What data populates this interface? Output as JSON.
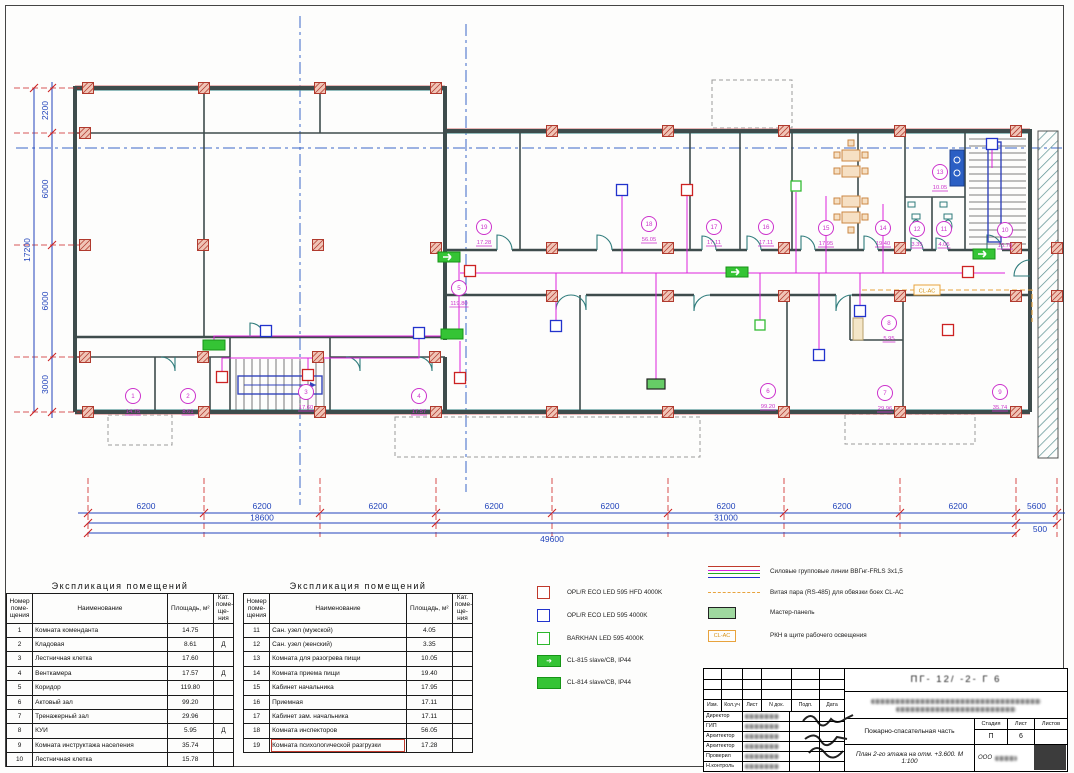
{
  "sheet": {
    "plan_caption": "План 2-го этажа на отм. +3.600. М 1:100"
  },
  "explication": {
    "title": "Экспликация помещений",
    "headers": [
      "Номер поме-щения",
      "Наименование",
      "Площадь, м²",
      "Кат. поме-ще-ния"
    ],
    "left_rows": [
      [
        "1",
        "Комната коменданта",
        "14.75",
        ""
      ],
      [
        "2",
        "Кладовая",
        "8.61",
        "Д"
      ],
      [
        "3",
        "Лестничная клетка",
        "17.60",
        ""
      ],
      [
        "4",
        "Венткамера",
        "17.57",
        "Д"
      ],
      [
        "5",
        "Коридор",
        "119.80",
        ""
      ],
      [
        "6",
        "Актовый зал",
        "99.20",
        ""
      ],
      [
        "7",
        "Тренажерный зал",
        "29.96",
        ""
      ],
      [
        "8",
        "КУИ",
        "5.95",
        "Д"
      ],
      [
        "9",
        "Комната инструктажа населения",
        "35.74",
        ""
      ],
      [
        "10",
        "Лестничная клетка",
        "15.78",
        ""
      ]
    ],
    "right_rows": [
      [
        "11",
        "Сан. узел (мужской)",
        "4.05",
        ""
      ],
      [
        "12",
        "Сан. узел (женский)",
        "3.35",
        ""
      ],
      [
        "13",
        "Комната для разогрева пищи",
        "10.05",
        ""
      ],
      [
        "14",
        "Комната приема пищи",
        "19.40",
        ""
      ],
      [
        "15",
        "Кабинет начальника",
        "17.95",
        ""
      ],
      [
        "16",
        "Приемная",
        "17.11",
        ""
      ],
      [
        "17",
        "Кабинет зам. начальника",
        "17.11",
        ""
      ],
      [
        "18",
        "Комната инспекторов",
        "56.05",
        ""
      ],
      [
        "19",
        "Комната психологической разгрузки",
        "17.28",
        ""
      ]
    ],
    "highlighted_room": "19"
  },
  "legend": {
    "fixtures": [
      {
        "sym": "sq red",
        "label": "OPL/R ECO LED 595 HFD 4000K"
      },
      {
        "sym": "sq blue",
        "label": "OPL/R ECO LED 595 4000K"
      },
      {
        "sym": "sq green",
        "label": "BARKHAN LED 595 4000K"
      },
      {
        "sym": "exit arrow",
        "label": "CL-815 slave/СВ, IP44"
      },
      {
        "sym": "exit solid",
        "label": "CL-814 slave/СВ, IP44"
      }
    ],
    "lines": [
      {
        "sym": "linestack",
        "label": "Силовые групповые линии ВВГнг-FRLS 3х1,5"
      },
      {
        "sym": "odash",
        "label": "Витая пара (RS-485) для обвязки боех CL-АС"
      },
      {
        "sym": "mpanel",
        "label": "Мастер-панель"
      },
      {
        "sym": "clacbox",
        "label": "РКН в щите рабочего освещения",
        "boxtext": "CL-АС"
      }
    ],
    "line_colors": [
      "#c0392b",
      "#dd22dd",
      "#22aa22",
      "#2233cc"
    ]
  },
  "titleblock": {
    "doc_number": "ПГ- 12/ -2- Г 6",
    "header_cols": [
      "Изм.",
      "Кол.уч",
      "Лист",
      "N док.",
      "Подп.",
      "Дата"
    ],
    "roles": [
      "Директор",
      "ГИП",
      "Архитектор",
      "Архитектор",
      "Проверил",
      "Н.контроль"
    ],
    "section_label": "Пожарно-спасательная часть",
    "sheet_label": "План 2-го этажа на отм. +3.600. М 1:100",
    "stage_headers": [
      "Стадия",
      "Лист",
      "Листов"
    ],
    "stage_value": "П",
    "sheet_value": "6",
    "company_prefix": "ООО"
  },
  "plan": {
    "cl_ac_label": "CL-АС",
    "dims": {
      "bottom_segments": [
        "6200",
        "6200",
        "6200",
        "6200",
        "6200",
        "6200",
        "6200",
        "6200",
        "5600"
      ],
      "bottom_totals": [
        {
          "label": "18600",
          "x1": 88,
          "x2": 436
        },
        {
          "label": "31000",
          "x1": 436,
          "x2": 1016
        }
      ],
      "bottom_overall": {
        "label": "49600",
        "x1": 88,
        "x2": 1016
      },
      "bottom_extra": "500",
      "left_segments": [
        "2200",
        "6000",
        "6000",
        "3000"
      ],
      "left_total": "17200"
    },
    "rooms": [
      {
        "num": "1",
        "area": "14.75",
        "x": 133,
        "y": 396
      },
      {
        "num": "2",
        "area": "8.61",
        "x": 188,
        "y": 396
      },
      {
        "num": "3",
        "area": "17.60",
        "x": 306,
        "y": 392
      },
      {
        "num": "4",
        "area": "17.57",
        "x": 419,
        "y": 396
      },
      {
        "num": "5",
        "area": "119.80",
        "x": 459,
        "y": 288
      },
      {
        "num": "6",
        "area": "99.20",
        "x": 768,
        "y": 391
      },
      {
        "num": "7",
        "area": "29.96",
        "x": 885,
        "y": 393
      },
      {
        "num": "8",
        "area": "5.95",
        "x": 889,
        "y": 323
      },
      {
        "num": "9",
        "area": "35.74",
        "x": 1000,
        "y": 392
      },
      {
        "num": "10",
        "area": "15.78",
        "x": 1005,
        "y": 230
      },
      {
        "num": "11",
        "area": "4.05",
        "x": 944,
        "y": 229
      },
      {
        "num": "12",
        "area": "3.35",
        "x": 917,
        "y": 229
      },
      {
        "num": "13",
        "area": "10.05",
        "x": 940,
        "y": 172
      },
      {
        "num": "14",
        "area": "19.40",
        "x": 883,
        "y": 228
      },
      {
        "num": "15",
        "area": "17.95",
        "x": 826,
        "y": 228
      },
      {
        "num": "16",
        "area": "17.11",
        "x": 766,
        "y": 227
      },
      {
        "num": "17",
        "area": "17.11",
        "x": 714,
        "y": 227
      },
      {
        "num": "18",
        "area": "56.05",
        "x": 649,
        "y": 224
      },
      {
        "num": "19",
        "area": "17.28",
        "x": 484,
        "y": 227
      }
    ],
    "devices": [
      {
        "type": "exit-arrow",
        "x": 449,
        "y": 257
      },
      {
        "type": "exit-arrow",
        "x": 737,
        "y": 272
      },
      {
        "type": "exit-arrow",
        "x": 984,
        "y": 254
      },
      {
        "type": "exit-solid",
        "x": 214,
        "y": 345
      },
      {
        "type": "exit-solid",
        "x": 452,
        "y": 334
      },
      {
        "type": "master-panel",
        "x": 656,
        "y": 384
      },
      {
        "type": "led",
        "x": 266,
        "y": 331
      },
      {
        "type": "led",
        "x": 419,
        "y": 333
      },
      {
        "type": "led",
        "x": 556,
        "y": 326
      },
      {
        "type": "led",
        "x": 622,
        "y": 190
      },
      {
        "type": "led",
        "x": 819,
        "y": 355
      },
      {
        "type": "led",
        "x": 860,
        "y": 311
      },
      {
        "type": "led",
        "x": 992,
        "y": 144
      },
      {
        "type": "led-hfd",
        "x": 222,
        "y": 377
      },
      {
        "type": "led-hfd",
        "x": 308,
        "y": 375
      },
      {
        "type": "led-hfd",
        "x": 460,
        "y": 378
      },
      {
        "type": "led-hfd",
        "x": 470,
        "y": 271
      },
      {
        "type": "led-hfd",
        "x": 687,
        "y": 190
      },
      {
        "type": "led-hfd",
        "x": 968,
        "y": 272
      },
      {
        "type": "led-hfd",
        "x": 948,
        "y": 330
      },
      {
        "type": "barkhan",
        "x": 760,
        "y": 325
      },
      {
        "type": "barkhan",
        "x": 796,
        "y": 186
      }
    ]
  }
}
